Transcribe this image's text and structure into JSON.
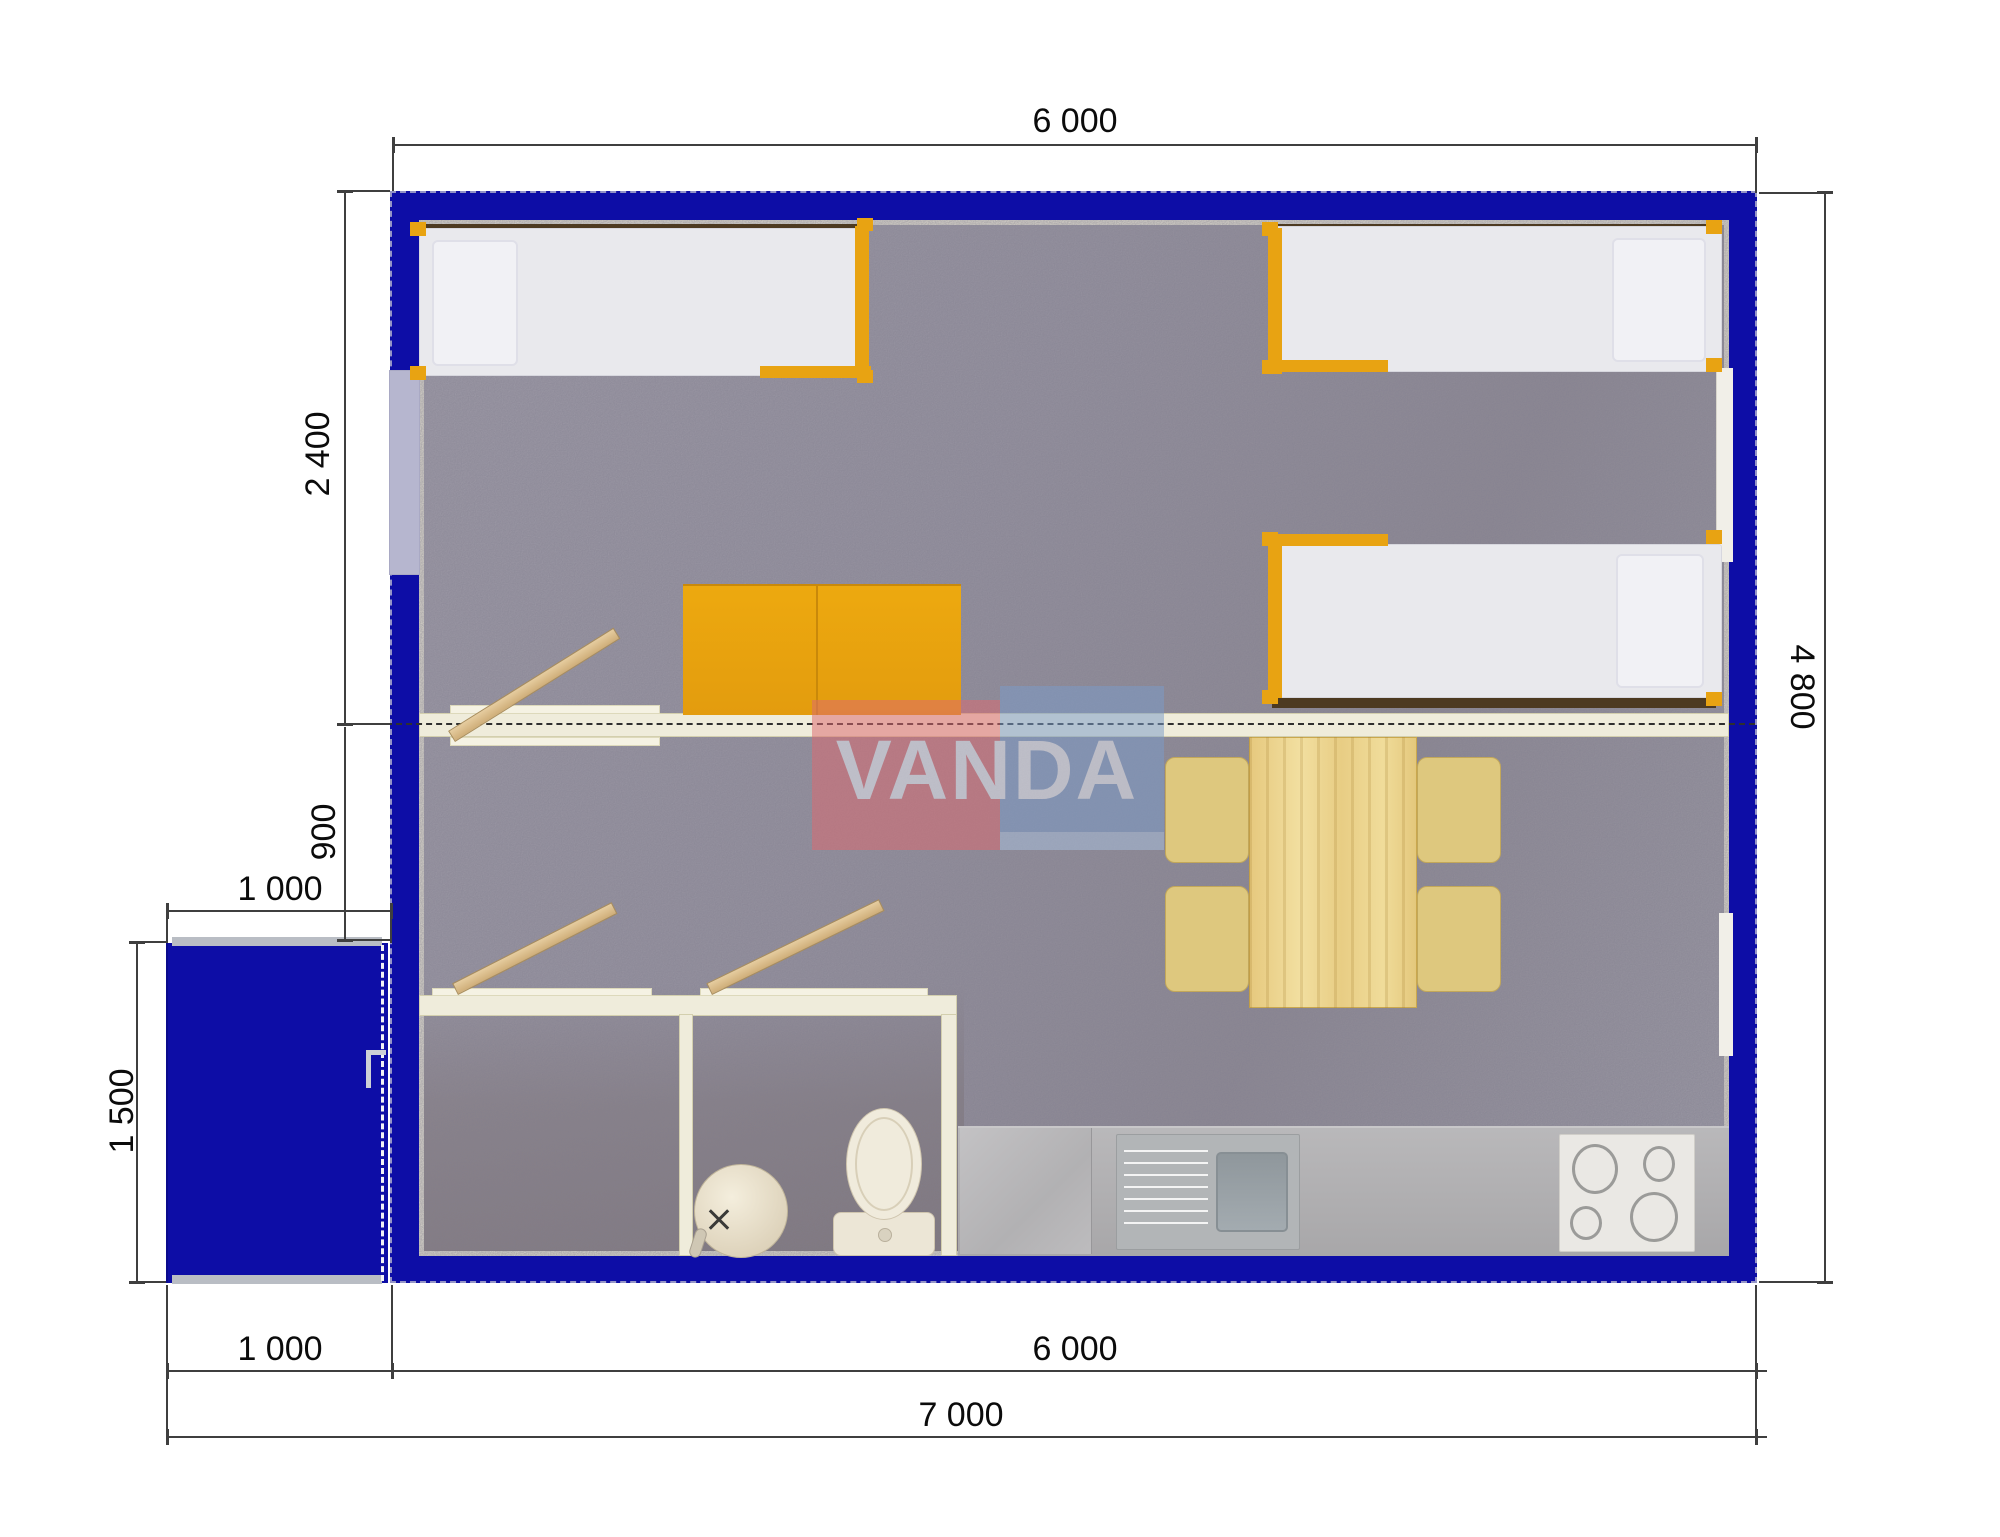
{
  "watermark": {
    "text": "VANDA"
  },
  "dimensions": {
    "top_width": "6 000",
    "right_height": "4 800",
    "bedroom_depth": "2 400",
    "hall_depth": "900",
    "porch_width": "1 000",
    "porch_depth": "1 500",
    "bottom_porch_width": "1 000",
    "bottom_body_width": "6 000",
    "bottom_total_width": "7 000"
  },
  "colors": {
    "wall_blue": "#0d0da6",
    "floor_carpet": "#9d99a6",
    "partition_cream": "#efecdb",
    "furniture_orange": "#e8a312",
    "wood_pine": "#ecd28b",
    "chair_tan": "#dec87e",
    "counter_gray": "#b0afb1",
    "fixture_cream": "#efeade",
    "dimension_line": "#3f3f3f",
    "watermark_red": "#dd6a70",
    "watermark_blue": "#7b9cc9",
    "watermark_cyan": "#cdeeea"
  },
  "objects": {
    "beds": 3,
    "orange_desks": 2,
    "dining_table": 1,
    "dining_chairs": 4,
    "toilet": 1,
    "wash_basin": 1,
    "kitchen_sink": 1,
    "kitchen_hob_burners": 4
  }
}
